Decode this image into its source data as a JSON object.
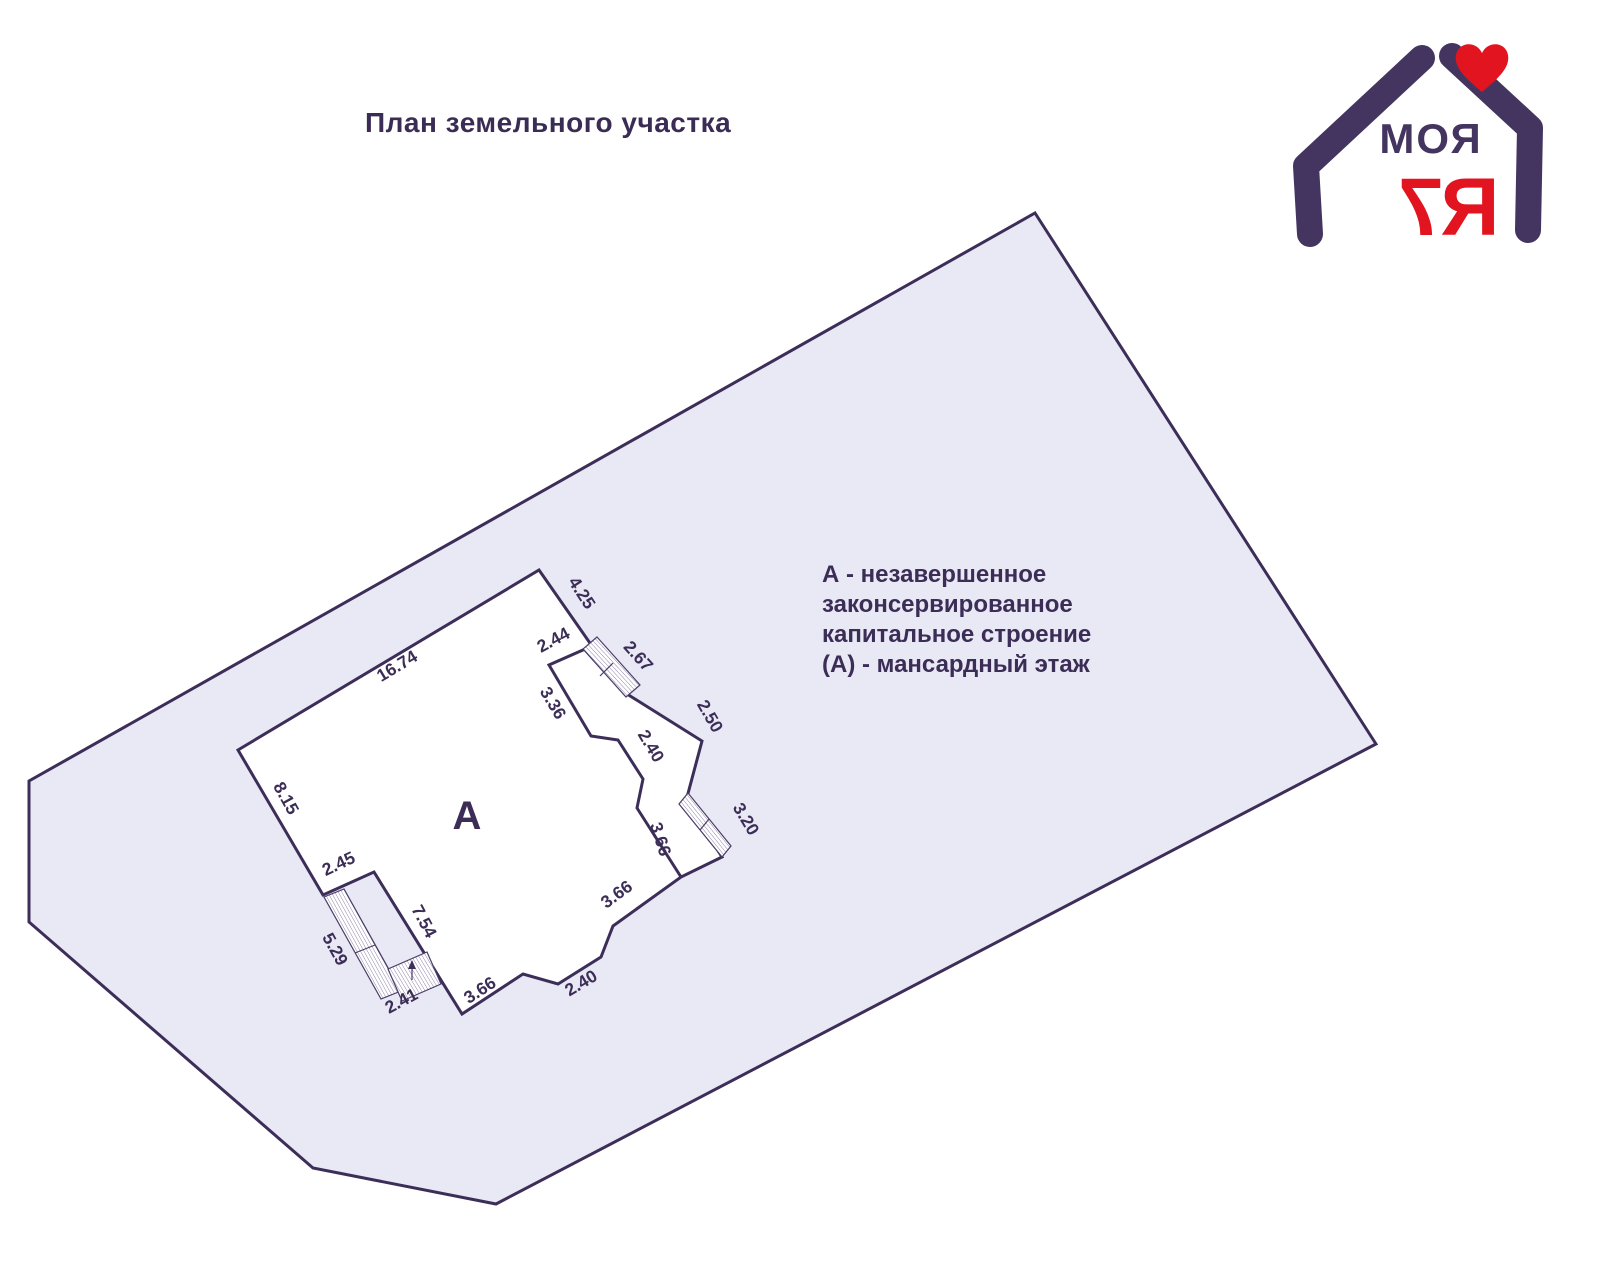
{
  "title": "План земельного участка",
  "logo": {
    "word_top": "МОЯ",
    "digit": "7",
    "letter_ya": "Я"
  },
  "legend": {
    "line1": "А - незавершенное",
    "line2": "законсервированное",
    "line3": "капитальное строение",
    "line4": "(А) - мансардный этаж"
  },
  "plan": {
    "building_label": "А",
    "dims": [
      "16.74",
      "8.15",
      "2.45",
      "5.29",
      "7.54",
      "2.41",
      "3.66",
      "2.40",
      "3.66",
      "3.66",
      "3.20",
      "2.50",
      "2.40",
      "3.36",
      "2.44",
      "2.67",
      "4.25"
    ]
  },
  "colors": {
    "line_purple": "#3c2e58",
    "plot_fill": "#e9e8f5",
    "text_purple": "#3b2d56",
    "logo_purple": "#443560",
    "logo_red": "#e1141f",
    "background": "#ffffff"
  }
}
